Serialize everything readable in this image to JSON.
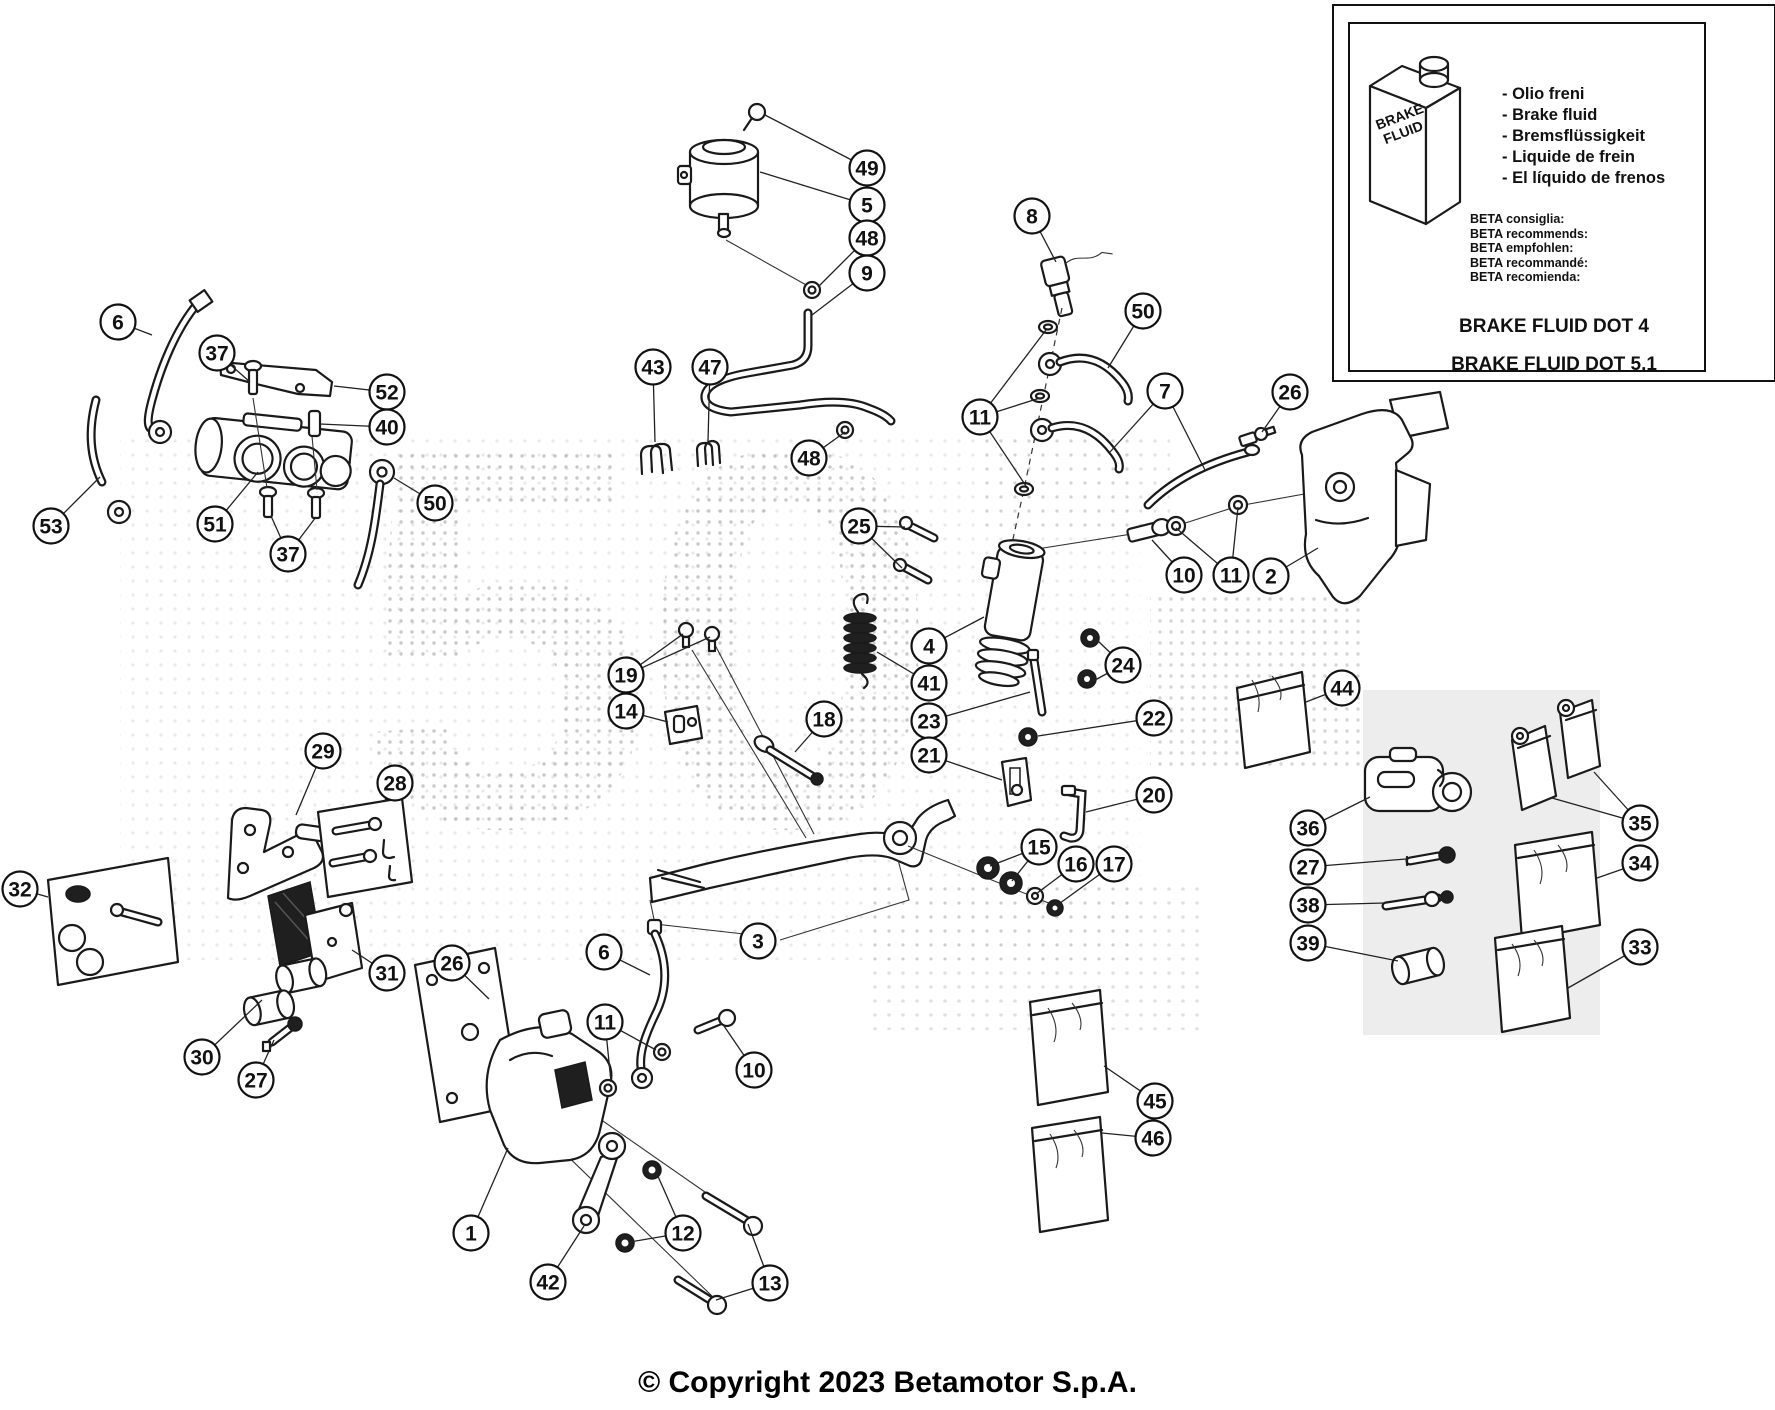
{
  "meta": {
    "copyright": "© Copyright 2023 Betamotor S.p.A."
  },
  "info_box": {
    "bottle_label": [
      "BRAKE",
      "FLUID"
    ],
    "fluid_names": [
      "- Olio freni",
      "- Brake fluid",
      "- Bremsflüssigkeit",
      "- Liquide de frein",
      "- El líquido de frenos"
    ],
    "recommendations": [
      "BETA consiglia:",
      "BETA recommends:",
      "BETA empfohlen:",
      "BETA recommandé:",
      "BETA recomienda:"
    ],
    "dot4": "BRAKE FLUID DOT 4",
    "dot51": "BRAKE FLUID DOT 5.1"
  },
  "callouts": [
    {
      "n": "49",
      "x": 867,
      "y": 168,
      "leaders": [
        [
          765,
          115
        ]
      ]
    },
    {
      "n": "5",
      "x": 867,
      "y": 205,
      "leaders": [
        [
          760,
          172
        ]
      ]
    },
    {
      "n": "48",
      "x": 867,
      "y": 238,
      "leaders": [
        [
          818,
          287
        ]
      ]
    },
    {
      "n": "9",
      "x": 867,
      "y": 273,
      "leaders": [
        [
          812,
          315
        ]
      ]
    },
    {
      "n": "8",
      "x": 1032,
      "y": 216,
      "leaders": [
        [
          1056,
          262
        ]
      ]
    },
    {
      "n": "50",
      "x": 1143,
      "y": 311,
      "leaders": [
        [
          1108,
          368
        ]
      ]
    },
    {
      "n": "7",
      "x": 1165,
      "y": 391,
      "leaders": [
        [
          1110,
          452
        ],
        [
          1205,
          470
        ]
      ]
    },
    {
      "n": "26",
      "x": 1290,
      "y": 392,
      "leaders": [
        [
          1262,
          432
        ]
      ]
    },
    {
      "n": "11",
      "x": 980,
      "y": 417,
      "leaders": [
        [
          1046,
          330
        ],
        [
          1040,
          398
        ],
        [
          1026,
          486
        ]
      ]
    },
    {
      "n": "43",
      "x": 653,
      "y": 367,
      "leaders": [
        [
          655,
          442
        ]
      ]
    },
    {
      "n": "47",
      "x": 710,
      "y": 367,
      "leaders": [
        [
          708,
          441
        ]
      ]
    },
    {
      "n": "48",
      "x": 809,
      "y": 458,
      "leaders": [
        [
          845,
          432
        ]
      ]
    },
    {
      "n": "25",
      "x": 859,
      "y": 526,
      "leaders": [
        [
          905,
          527
        ],
        [
          902,
          568
        ]
      ]
    },
    {
      "n": "4",
      "x": 929,
      "y": 646,
      "leaders": [
        [
          984,
          617
        ]
      ]
    },
    {
      "n": "41",
      "x": 929,
      "y": 683,
      "leaders": [
        [
          877,
          652
        ]
      ]
    },
    {
      "n": "23",
      "x": 929,
      "y": 721,
      "leaders": [
        [
          1030,
          692
        ]
      ]
    },
    {
      "n": "21",
      "x": 929,
      "y": 755,
      "leaders": [
        [
          1002,
          780
        ]
      ]
    },
    {
      "n": "18",
      "x": 824,
      "y": 719,
      "leaders": [
        [
          795,
          752
        ]
      ]
    },
    {
      "n": "19",
      "x": 626,
      "y": 675,
      "leaders": [
        [
          683,
          634
        ],
        [
          710,
          637
        ]
      ]
    },
    {
      "n": "14",
      "x": 626,
      "y": 711,
      "leaders": [
        [
          668,
          722
        ]
      ]
    },
    {
      "n": "22",
      "x": 1154,
      "y": 718,
      "leaders": [
        [
          1038,
          736
        ]
      ]
    },
    {
      "n": "20",
      "x": 1154,
      "y": 795,
      "leaders": [
        [
          1086,
          812
        ]
      ]
    },
    {
      "n": "24",
      "x": 1123,
      "y": 665,
      "leaders": [
        [
          1097,
          640
        ],
        [
          1095,
          680
        ]
      ]
    },
    {
      "n": "10",
      "x": 1184,
      "y": 575,
      "leaders": [
        [
          1152,
          540
        ]
      ]
    },
    {
      "n": "11",
      "x": 1231,
      "y": 575,
      "leaders": [
        [
          1176,
          528
        ],
        [
          1238,
          507
        ]
      ]
    },
    {
      "n": "2",
      "x": 1271,
      "y": 576,
      "leaders": [
        [
          1318,
          548
        ]
      ]
    },
    {
      "n": "15",
      "x": 1039,
      "y": 847,
      "leaders": [
        [
          990,
          866
        ],
        [
          1012,
          881
        ]
      ]
    },
    {
      "n": "16",
      "x": 1076,
      "y": 864,
      "leaders": [
        [
          1036,
          894
        ]
      ]
    },
    {
      "n": "17",
      "x": 1114,
      "y": 864,
      "leaders": [
        [
          1056,
          906
        ]
      ]
    },
    {
      "n": "3",
      "x": 758,
      "y": 941,
      "leaders": [
        [
          744,
          932
        ]
      ]
    },
    {
      "n": "6",
      "x": 118,
      "y": 322,
      "leaders": [
        [
          152,
          335
        ]
      ]
    },
    {
      "n": "37",
      "x": 217,
      "y": 353,
      "leaders": [
        [
          250,
          382
        ]
      ]
    },
    {
      "n": "52",
      "x": 387,
      "y": 392,
      "leaders": [
        [
          334,
          386
        ]
      ]
    },
    {
      "n": "40",
      "x": 387,
      "y": 427,
      "leaders": [
        [
          320,
          424
        ]
      ]
    },
    {
      "n": "53",
      "x": 51,
      "y": 526,
      "leaders": [
        [
          100,
          477
        ]
      ]
    },
    {
      "n": "51",
      "x": 215,
      "y": 524,
      "leaders": [
        [
          258,
          472
        ]
      ]
    },
    {
      "n": "37",
      "x": 288,
      "y": 554,
      "leaders": [
        [
          271,
          516
        ],
        [
          316,
          517
        ]
      ]
    },
    {
      "n": "50",
      "x": 435,
      "y": 503,
      "leaders": [
        [
          394,
          478
        ]
      ]
    },
    {
      "n": "29",
      "x": 323,
      "y": 751,
      "leaders": [
        [
          296,
          815
        ]
      ]
    },
    {
      "n": "28",
      "x": 395,
      "y": 783,
      "leaders": [
        [
          384,
          802
        ]
      ]
    },
    {
      "n": "32",
      "x": 20,
      "y": 889,
      "leaders": [
        [
          48,
          897
        ]
      ]
    },
    {
      "n": "31",
      "x": 387,
      "y": 973,
      "leaders": [
        [
          352,
          950
        ]
      ]
    },
    {
      "n": "30",
      "x": 202,
      "y": 1057,
      "leaders": [
        [
          262,
          1000
        ]
      ]
    },
    {
      "n": "27",
      "x": 256,
      "y": 1080,
      "leaders": [
        [
          274,
          1040
        ]
      ]
    },
    {
      "n": "26",
      "x": 452,
      "y": 963,
      "leaders": [
        [
          489,
          999
        ]
      ]
    },
    {
      "n": "6",
      "x": 604,
      "y": 952,
      "leaders": [
        [
          650,
          975
        ]
      ]
    },
    {
      "n": "11",
      "x": 605,
      "y": 1022,
      "leaders": [
        [
          611,
          1082
        ],
        [
          656,
          1050
        ]
      ]
    },
    {
      "n": "10",
      "x": 754,
      "y": 1070,
      "leaders": [
        [
          724,
          1026
        ]
      ]
    },
    {
      "n": "1",
      "x": 471,
      "y": 1233,
      "leaders": [
        [
          508,
          1148
        ]
      ]
    },
    {
      "n": "42",
      "x": 548,
      "y": 1282,
      "leaders": [
        [
          584,
          1226
        ]
      ]
    },
    {
      "n": "12",
      "x": 683,
      "y": 1233,
      "leaders": [
        [
          657,
          1174
        ],
        [
          630,
          1242
        ]
      ]
    },
    {
      "n": "13",
      "x": 770,
      "y": 1283,
      "leaders": [
        [
          748,
          1224
        ],
        [
          716,
          1300
        ]
      ]
    },
    {
      "n": "44",
      "x": 1342,
      "y": 688,
      "leaders": [
        [
          1306,
          702
        ]
      ]
    },
    {
      "n": "36",
      "x": 1308,
      "y": 828,
      "leaders": [
        [
          1370,
          797
        ]
      ]
    },
    {
      "n": "27",
      "x": 1308,
      "y": 867,
      "leaders": [
        [
          1406,
          859
        ]
      ]
    },
    {
      "n": "38",
      "x": 1308,
      "y": 905,
      "leaders": [
        [
          1385,
          903
        ]
      ]
    },
    {
      "n": "39",
      "x": 1308,
      "y": 943,
      "leaders": [
        [
          1398,
          961
        ]
      ]
    },
    {
      "n": "35",
      "x": 1640,
      "y": 823,
      "leaders": [
        [
          1552,
          798
        ],
        [
          1594,
          772
        ]
      ]
    },
    {
      "n": "34",
      "x": 1640,
      "y": 863,
      "leaders": [
        [
          1597,
          878
        ]
      ]
    },
    {
      "n": "33",
      "x": 1640,
      "y": 947,
      "leaders": [
        [
          1568,
          988
        ]
      ]
    },
    {
      "n": "45",
      "x": 1155,
      "y": 1101,
      "leaders": [
        [
          1104,
          1066
        ]
      ]
    },
    {
      "n": "46",
      "x": 1153,
      "y": 1138,
      "leaders": [
        [
          1102,
          1133
        ]
      ]
    }
  ]
}
